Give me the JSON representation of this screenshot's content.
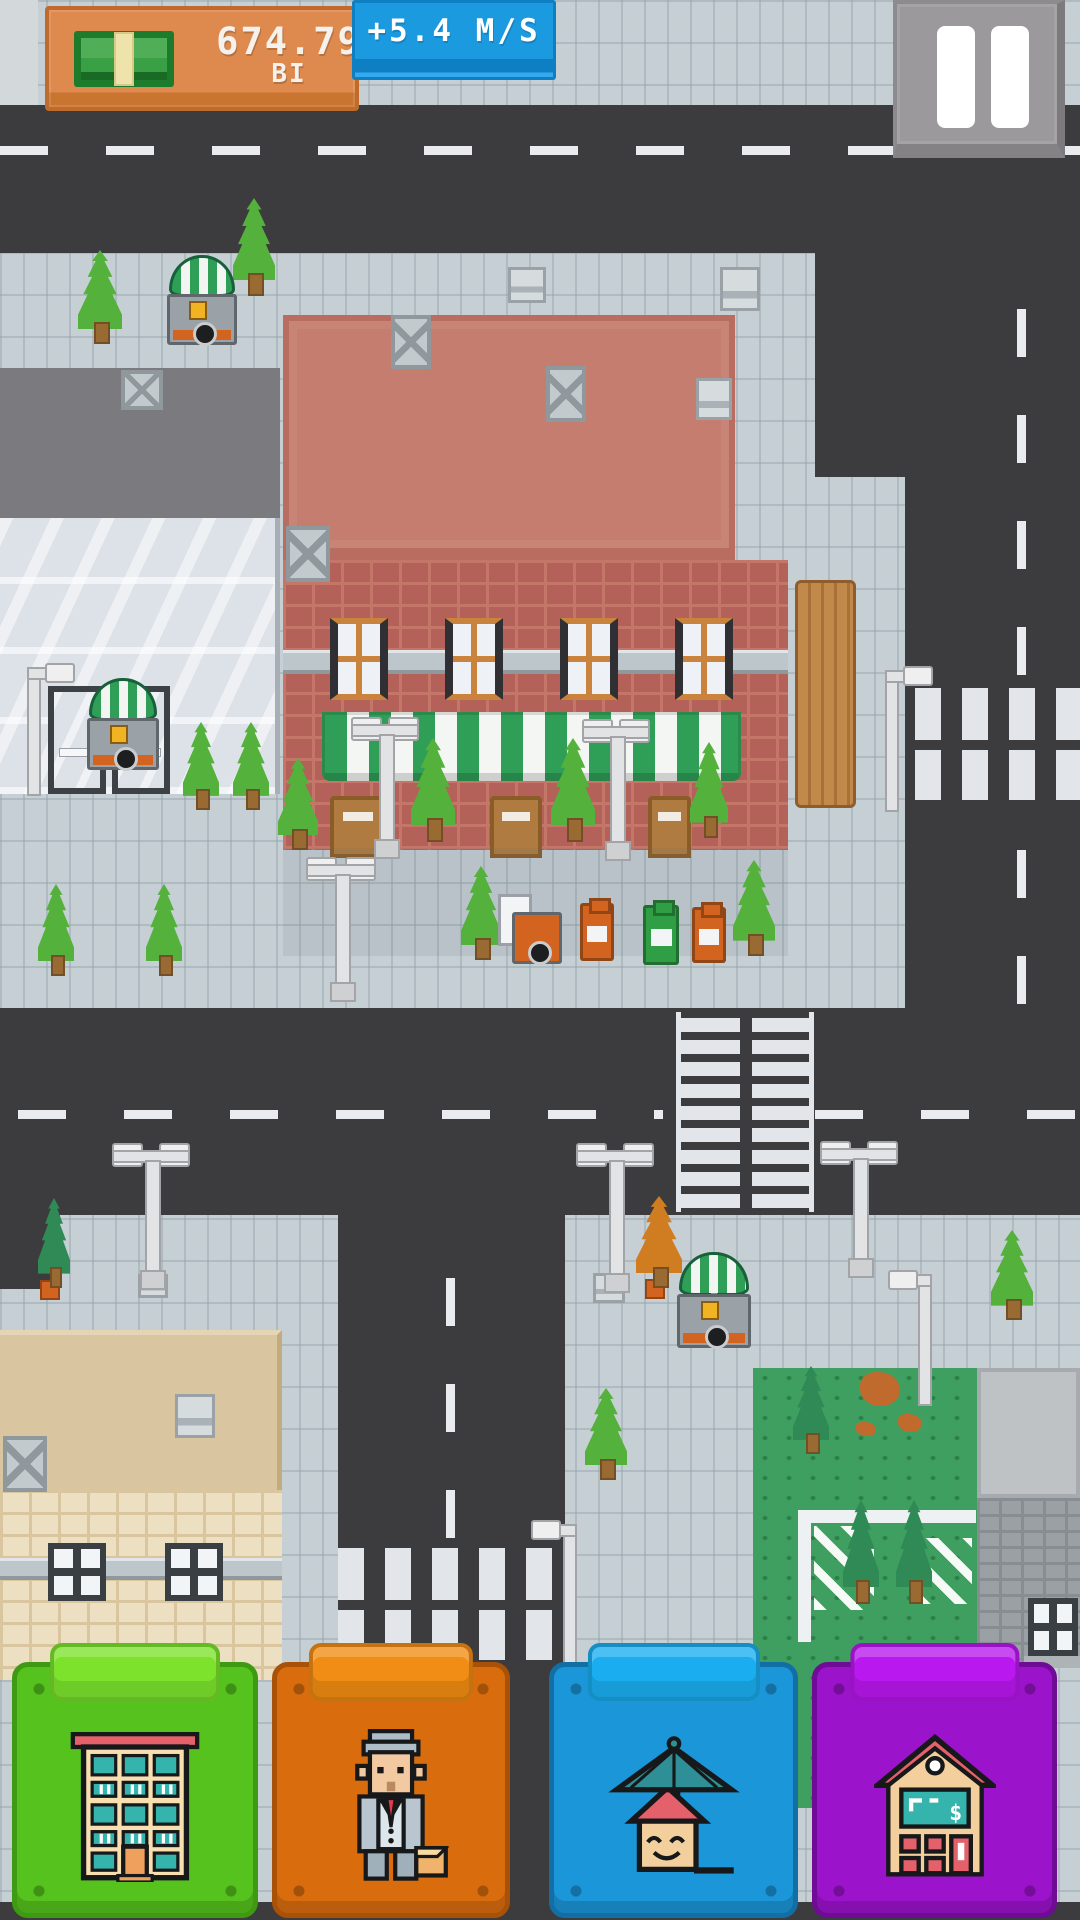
{
  "hud": {
    "money": {
      "value": "674.79",
      "suffix": "BI",
      "icon": "money-bill-icon"
    },
    "income": {
      "label": "+5.4 M/S"
    },
    "pause": {
      "icon": "pause-icon"
    }
  },
  "bottom_bar": {
    "buttons": [
      {
        "id": "residential-buildings",
        "icon": "apartment-building-icon",
        "color_key": "btn_green"
      },
      {
        "id": "managers",
        "icon": "bellboy-icon",
        "color_key": "btn_orange"
      },
      {
        "id": "leisure",
        "icon": "house-umbrella-icon",
        "color_key": "btn_blue"
      },
      {
        "id": "finance",
        "icon": "house-calculator-icon",
        "color_key": "btn_purple"
      }
    ]
  },
  "scene": {
    "props": [
      "cafe-building",
      "glass-office-building",
      "apartment-building",
      "street-cart",
      "street-lamp",
      "tree",
      "trash-bin",
      "crosswalk",
      "park",
      "roof-vent"
    ]
  },
  "colors": {
    "road": "#3c3b3d",
    "sidewalk": "#c6cfd4",
    "tile_line": "rgba(144,162,171,0.45)",
    "dash": "#e9ebee",
    "zebra": "#e2e6ea",
    "cafe_roof": "#c57d6f",
    "cafe_roof_edge": "#b96d60",
    "cafe_brick": "#b4615a",
    "cafe_mortar": "#c47769",
    "awning_green": "#2f9e57",
    "awning_white": "#f4f6f4",
    "window_frame": "#c9833c",
    "door_brown": "#b07b40",
    "fence": "#c28a4a",
    "glass_hi": "#f1f3f6",
    "glass_lo": "#dde2e9",
    "left_roof": "#7b7b7f",
    "tan_roof": "#d9c5a0",
    "cream_brick": "#ecdfc2",
    "cream_mortar": "#d9c69e",
    "grass": "#3f9f60",
    "dirt": "#c06a2d",
    "tree_green": "#53b13c",
    "tree_dark": "#2f8a55",
    "tree_autumn": "#d07d22",
    "trunk": "#9a6a33",
    "lamp_fill": "#e2e3e5",
    "lamp_line": "#a2a4a8",
    "bin_orange": "#d2641f",
    "bin_green": "#2f9e45",
    "gray_brick": "#9aa0a4",
    "gray_mortar": "#878d91",
    "concrete": "#bfc2c5",
    "hud_orange": "#de8a4f",
    "hud_orange_border": "#c06a2c",
    "hud_blue": "#1b9ae0",
    "hud_blue_border": "#0e7fc2",
    "pause_bg": "#9c999c",
    "pause_edge": "#7d7a7d",
    "btn_green": "#55c21d",
    "btn_green_tab": "#7ce22c",
    "btn_green_edge": "#3e9a12",
    "btn_orange": "#d96d0e",
    "btn_orange_tab": "#f18d14",
    "btn_orange_edge": "#a85107",
    "btn_blue": "#1b96d8",
    "btn_blue_tab": "#1aaef0",
    "btn_blue_edge": "#126fa6",
    "btn_purple": "#9b13ca",
    "btn_purple_tab": "#b918ee",
    "btn_purple_edge": "#6f0b94",
    "icon_cream": "#f8dfb0",
    "icon_teal": "#35b3ad",
    "icon_red": "#e4606b",
    "icon_tan": "#f2cf9d",
    "icon_orange": "#efa05c",
    "icon_suit": "#b9c6cf",
    "icon_face": "#f2c9a0",
    "icon_hat": "#aebec8",
    "icon_tie": "#e23b4e",
    "icon_case": "#efb36b",
    "icon_umbrella": "#2e8f96",
    "outline": "#17181a"
  }
}
